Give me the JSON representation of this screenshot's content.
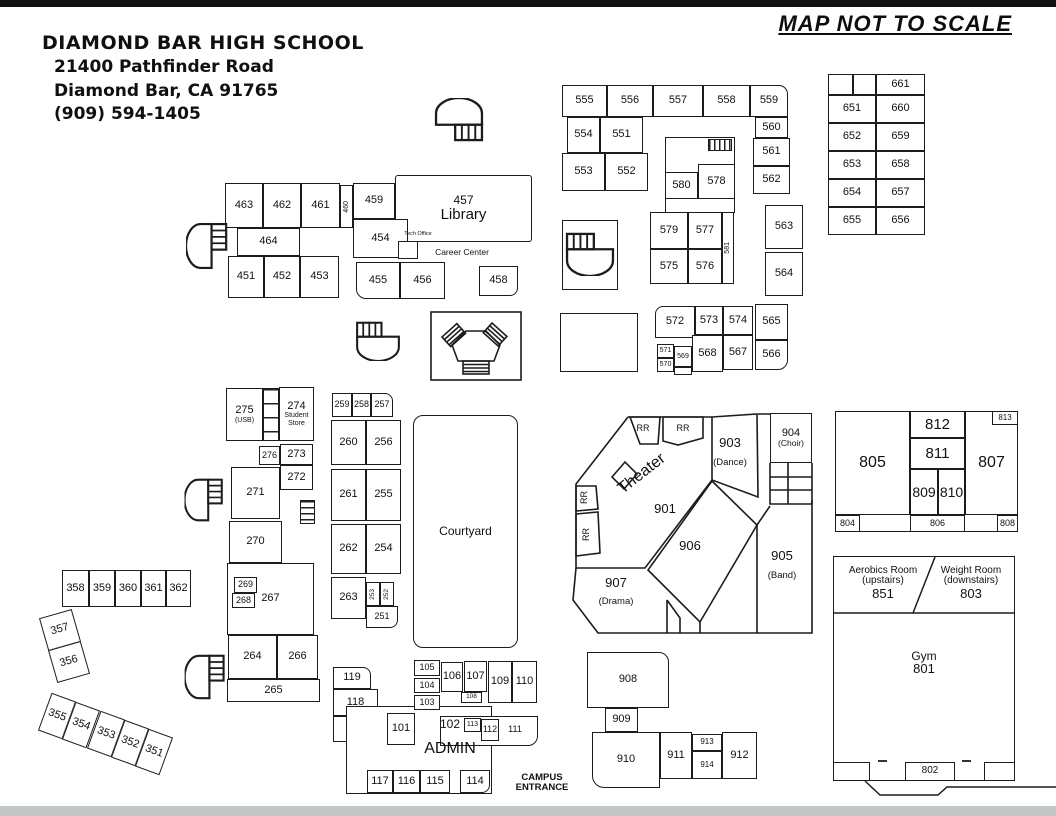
{
  "header": {
    "school": "DIAMOND BAR HIGH SCHOOL",
    "address1": "21400 Pathfinder Road",
    "address2": "Diamond Bar, CA 91765",
    "phone": "(909) 594-1405"
  },
  "map_note": "MAP NOT TO SCALE",
  "colors": {
    "line": "#1c1c1c",
    "top_bar": "#111111",
    "bottom_bar": "#c3c7c3",
    "paper": "#ffffff"
  },
  "rooms": [
    {
      "id": "cell-blank-1",
      "n": "",
      "x": 828,
      "y": 74,
      "w": 25,
      "h": 21
    },
    {
      "id": "cell-blank-2",
      "n": "",
      "x": 853,
      "y": 74,
      "w": 23,
      "h": 21
    },
    {
      "n": "661",
      "x": 876,
      "y": 74,
      "w": 49,
      "h": 21
    },
    {
      "n": "651",
      "x": 828,
      "y": 95,
      "w": 48,
      "h": 28
    },
    {
      "n": "660",
      "x": 876,
      "y": 95,
      "w": 49,
      "h": 28
    },
    {
      "n": "652",
      "x": 828,
      "y": 123,
      "w": 48,
      "h": 28
    },
    {
      "n": "659",
      "x": 876,
      "y": 123,
      "w": 49,
      "h": 28
    },
    {
      "n": "653",
      "x": 828,
      "y": 151,
      "w": 48,
      "h": 28
    },
    {
      "n": "658",
      "x": 876,
      "y": 151,
      "w": 49,
      "h": 28
    },
    {
      "n": "654",
      "x": 828,
      "y": 179,
      "w": 48,
      "h": 28
    },
    {
      "n": "657",
      "x": 876,
      "y": 179,
      "w": 49,
      "h": 28
    },
    {
      "n": "655",
      "x": 828,
      "y": 207,
      "w": 48,
      "h": 28
    },
    {
      "n": "656",
      "x": 876,
      "y": 207,
      "w": 49,
      "h": 28
    },
    {
      "n": "555",
      "x": 562,
      "y": 85,
      "w": 45,
      "h": 32
    },
    {
      "n": "556",
      "x": 607,
      "y": 85,
      "w": 46,
      "h": 32
    },
    {
      "n": "557",
      "x": 653,
      "y": 85,
      "w": 50,
      "h": 32
    },
    {
      "n": "558",
      "x": 703,
      "y": 85,
      "w": 47,
      "h": 32
    },
    {
      "n": "559",
      "x": 750,
      "y": 85,
      "w": 38,
      "h": 32,
      "br": "0 9px 0 0"
    },
    {
      "n": "554",
      "x": 567,
      "y": 117,
      "w": 33,
      "h": 36
    },
    {
      "n": "551",
      "x": 600,
      "y": 117,
      "w": 43,
      "h": 36
    },
    {
      "n": "553",
      "x": 562,
      "y": 153,
      "w": 43,
      "h": 38
    },
    {
      "n": "552",
      "x": 605,
      "y": 153,
      "w": 43,
      "h": 38
    },
    {
      "n": "560",
      "x": 755,
      "y": 117,
      "w": 33,
      "h": 21
    },
    {
      "n": "561",
      "x": 753,
      "y": 138,
      "w": 37,
      "h": 28
    },
    {
      "n": "562",
      "x": 753,
      "y": 166,
      "w": 37,
      "h": 28
    },
    {
      "n": "563",
      "x": 765,
      "y": 205,
      "w": 38,
      "h": 44
    },
    {
      "n": "564",
      "x": 765,
      "y": 252,
      "w": 38,
      "h": 44
    },
    {
      "id": "block-578-outline",
      "n": "",
      "x": 665,
      "y": 137,
      "w": 70,
      "h": 76
    },
    {
      "n": "580",
      "x": 665,
      "y": 172,
      "w": 33,
      "h": 27
    },
    {
      "n": "578",
      "x": 698,
      "y": 164,
      "w": 37,
      "h": 35
    },
    {
      "n": "579",
      "x": 650,
      "y": 212,
      "w": 38,
      "h": 37
    },
    {
      "n": "577",
      "x": 688,
      "y": 212,
      "w": 34,
      "h": 37
    },
    {
      "n": "575",
      "x": 650,
      "y": 249,
      "w": 38,
      "h": 35
    },
    {
      "n": "576",
      "x": 688,
      "y": 249,
      "w": 34,
      "h": 35
    },
    {
      "n": "581",
      "x": 722,
      "y": 212,
      "w": 12,
      "h": 72,
      "v": true,
      "fs": 7
    },
    {
      "id": "stair-box-550",
      "n": "",
      "x": 562,
      "y": 220,
      "w": 56,
      "h": 70
    },
    {
      "id": "blank-box",
      "n": "",
      "x": 560,
      "y": 313,
      "w": 78,
      "h": 59
    },
    {
      "n": "572",
      "x": 655,
      "y": 306,
      "w": 40,
      "h": 32,
      "br": "8px 0 0 0"
    },
    {
      "n": "573",
      "x": 695,
      "y": 306,
      "w": 28,
      "h": 29
    },
    {
      "n": "574",
      "x": 723,
      "y": 306,
      "w": 30,
      "h": 29
    },
    {
      "n": "565",
      "x": 755,
      "y": 304,
      "w": 33,
      "h": 36
    },
    {
      "n": "571",
      "x": 657,
      "y": 344,
      "w": 17,
      "h": 14,
      "fs": 7
    },
    {
      "n": "570",
      "x": 657,
      "y": 358,
      "w": 17,
      "h": 14,
      "fs": 7
    },
    {
      "n": "569",
      "x": 674,
      "y": 346,
      "w": 18,
      "h": 21,
      "fs": 7
    },
    {
      "id": "connector-569",
      "n": "",
      "x": 674,
      "y": 367,
      "w": 18,
      "h": 8
    },
    {
      "n": "568",
      "x": 692,
      "y": 335,
      "w": 31,
      "h": 37
    },
    {
      "n": "567",
      "x": 723,
      "y": 335,
      "w": 30,
      "h": 35
    },
    {
      "n": "566",
      "x": 755,
      "y": 340,
      "w": 33,
      "h": 30,
      "br": "0 0 10px 0"
    },
    {
      "n": "463",
      "x": 225,
      "y": 183,
      "w": 38,
      "h": 45
    },
    {
      "n": "462",
      "x": 263,
      "y": 183,
      "w": 38,
      "h": 45
    },
    {
      "n": "461",
      "x": 301,
      "y": 183,
      "w": 39,
      "h": 45
    },
    {
      "n": "460",
      "x": 340,
      "y": 185,
      "w": 13,
      "h": 43,
      "v": true,
      "fs": 7
    },
    {
      "n": "459",
      "x": 353,
      "y": 183,
      "w": 42,
      "h": 36
    },
    {
      "n": "457",
      "sub": "Library",
      "x": 395,
      "y": 175,
      "w": 137,
      "h": 67,
      "fs": 12,
      "subfs": 15,
      "br": "3px"
    },
    {
      "n": "464",
      "x": 237,
      "y": 228,
      "w": 63,
      "h": 28
    },
    {
      "n": "454",
      "x": 353,
      "y": 219,
      "w": 55,
      "h": 39
    },
    {
      "n": "451",
      "x": 228,
      "y": 256,
      "w": 36,
      "h": 42
    },
    {
      "n": "452",
      "x": 264,
      "y": 256,
      "w": 36,
      "h": 42
    },
    {
      "n": "453",
      "x": 300,
      "y": 256,
      "w": 39,
      "h": 42
    },
    {
      "n": "455",
      "x": 356,
      "y": 262,
      "w": 44,
      "h": 37,
      "br": "0 0 0 10px"
    },
    {
      "n": "456",
      "x": 400,
      "y": 262,
      "w": 45,
      "h": 37
    },
    {
      "n": "458",
      "x": 479,
      "y": 266,
      "w": 39,
      "h": 30,
      "br": "0 0 8px 0"
    },
    {
      "id": "tech-office-box",
      "n": "",
      "x": 398,
      "y": 241,
      "w": 20,
      "h": 18
    },
    {
      "id": "tech-office-label",
      "n": "Tech Office",
      "x": 396,
      "y": 230,
      "w": 44,
      "h": 9,
      "fs": 5.5,
      "plain": true
    },
    {
      "id": "career-center-label",
      "n": "Career Center",
      "x": 426,
      "y": 246,
      "w": 72,
      "h": 12,
      "fs": 8.5,
      "plain": true
    },
    {
      "n": "275",
      "sub": "(USB)",
      "x": 226,
      "y": 388,
      "w": 37,
      "h": 53,
      "subfs": 7
    },
    {
      "n": "274",
      "sub": "Student\nStore",
      "x": 279,
      "y": 387,
      "w": 35,
      "h": 54,
      "subfs": 7
    },
    {
      "n": "276",
      "x": 259,
      "y": 446,
      "w": 21,
      "h": 19,
      "fs": 9
    },
    {
      "n": "273",
      "x": 280,
      "y": 444,
      "w": 33,
      "h": 21
    },
    {
      "n": "272",
      "x": 280,
      "y": 465,
      "w": 33,
      "h": 25
    },
    {
      "n": "271",
      "x": 231,
      "y": 467,
      "w": 49,
      "h": 52
    },
    {
      "n": "270",
      "x": 229,
      "y": 521,
      "w": 53,
      "h": 42
    },
    {
      "n": "267",
      "x": 227,
      "y": 563,
      "w": 87,
      "h": 72
    },
    {
      "n": "269",
      "x": 234,
      "y": 577,
      "w": 23,
      "h": 16,
      "fs": 9
    },
    {
      "n": "268",
      "x": 232,
      "y": 593,
      "w": 23,
      "h": 15,
      "fs": 9
    },
    {
      "n": "264",
      "x": 228,
      "y": 635,
      "w": 49,
      "h": 44
    },
    {
      "n": "266",
      "x": 277,
      "y": 635,
      "w": 41,
      "h": 44
    },
    {
      "n": "265",
      "x": 227,
      "y": 679,
      "w": 93,
      "h": 23
    },
    {
      "n": "259",
      "x": 332,
      "y": 393,
      "w": 20,
      "h": 24,
      "fs": 9
    },
    {
      "n": "258",
      "x": 352,
      "y": 393,
      "w": 19,
      "h": 24,
      "fs": 9
    },
    {
      "n": "257",
      "x": 371,
      "y": 393,
      "w": 22,
      "h": 24,
      "fs": 9,
      "br": "0 8px 0 0"
    },
    {
      "n": "260",
      "x": 331,
      "y": 420,
      "w": 35,
      "h": 45
    },
    {
      "n": "256",
      "x": 366,
      "y": 420,
      "w": 35,
      "h": 45
    },
    {
      "n": "261",
      "x": 331,
      "y": 469,
      "w": 35,
      "h": 52
    },
    {
      "n": "255",
      "x": 366,
      "y": 469,
      "w": 35,
      "h": 52
    },
    {
      "n": "262",
      "x": 331,
      "y": 524,
      "w": 35,
      "h": 50
    },
    {
      "n": "254",
      "x": 366,
      "y": 524,
      "w": 35,
      "h": 50
    },
    {
      "n": "263",
      "x": 331,
      "y": 577,
      "w": 35,
      "h": 42
    },
    {
      "n": "253",
      "x": 366,
      "y": 582,
      "w": 14,
      "h": 24,
      "v": true,
      "fs": 6.5
    },
    {
      "n": "252",
      "x": 380,
      "y": 582,
      "w": 14,
      "h": 24,
      "v": true,
      "fs": 6.5
    },
    {
      "n": "251",
      "x": 366,
      "y": 606,
      "w": 32,
      "h": 22,
      "fs": 9,
      "br": "0 0 8px 0"
    },
    {
      "id": "courtyard",
      "n": "Courtyard",
      "x": 413,
      "y": 415,
      "w": 105,
      "h": 233,
      "fs": 12,
      "br": "10px"
    },
    {
      "n": "358",
      "x": 62,
      "y": 570,
      "w": 27,
      "h": 37
    },
    {
      "n": "359",
      "x": 89,
      "y": 570,
      "w": 26,
      "h": 37
    },
    {
      "n": "360",
      "x": 115,
      "y": 570,
      "w": 26,
      "h": 37
    },
    {
      "n": "361",
      "x": 141,
      "y": 570,
      "w": 25,
      "h": 37
    },
    {
      "n": "362",
      "x": 166,
      "y": 570,
      "w": 25,
      "h": 37
    },
    {
      "n": "357",
      "x": 43,
      "y": 613,
      "w": 34,
      "h": 34,
      "rot": -16
    },
    {
      "n": "356",
      "x": 52,
      "y": 645,
      "w": 34,
      "h": 34,
      "rot": -16
    },
    {
      "n": "355",
      "x": 44,
      "y": 696,
      "w": 26,
      "h": 40,
      "rot": 20
    },
    {
      "n": "354",
      "x": 68,
      "y": 705,
      "w": 26,
      "h": 40,
      "rot": 20
    },
    {
      "n": "353",
      "x": 93,
      "y": 714,
      "w": 26,
      "h": 40,
      "rot": 20
    },
    {
      "n": "352",
      "x": 117,
      "y": 723,
      "w": 26,
      "h": 40,
      "rot": 20
    },
    {
      "n": "351",
      "x": 141,
      "y": 732,
      "w": 26,
      "h": 40,
      "rot": 20
    },
    {
      "n": "119",
      "x": 333,
      "y": 667,
      "w": 38,
      "h": 22,
      "br": "0 8px 0 0"
    },
    {
      "n": "118",
      "x": 333,
      "y": 689,
      "w": 45,
      "h": 27
    },
    {
      "id": "bldg-118-tail",
      "n": "",
      "x": 333,
      "y": 716,
      "w": 22,
      "h": 26
    },
    {
      "id": "admin-shell",
      "n": "",
      "x": 346,
      "y": 706,
      "w": 146,
      "h": 88
    },
    {
      "id": "admin-wing",
      "n": "",
      "x": 440,
      "y": 716,
      "w": 98,
      "h": 30,
      "br": "0 0 10px 0"
    },
    {
      "n": "105",
      "x": 414,
      "y": 660,
      "w": 26,
      "h": 16,
      "fs": 9
    },
    {
      "n": "104",
      "x": 414,
      "y": 678,
      "w": 26,
      "h": 15,
      "fs": 9
    },
    {
      "n": "103",
      "x": 414,
      "y": 695,
      "w": 26,
      "h": 15,
      "fs": 9
    },
    {
      "n": "106",
      "x": 441,
      "y": 662,
      "w": 22,
      "h": 30
    },
    {
      "n": "107",
      "x": 464,
      "y": 661,
      "w": 23,
      "h": 31
    },
    {
      "n": "108",
      "x": 461,
      "y": 692,
      "w": 21,
      "h": 11,
      "fs": 6.5
    },
    {
      "n": "109",
      "x": 488,
      "y": 661,
      "w": 24,
      "h": 42
    },
    {
      "n": "110",
      "x": 512,
      "y": 661,
      "w": 25,
      "h": 42
    },
    {
      "n": "101",
      "x": 387,
      "y": 713,
      "w": 28,
      "h": 32
    },
    {
      "id": "label-102",
      "n": "102",
      "x": 436,
      "y": 715,
      "w": 28,
      "h": 18,
      "plain": true,
      "fs": 12
    },
    {
      "n": "113",
      "x": 464,
      "y": 718,
      "w": 17,
      "h": 14,
      "fs": 7
    },
    {
      "n": "112",
      "x": 481,
      "y": 719,
      "w": 18,
      "h": 22,
      "fs": 9
    },
    {
      "id": "label-111",
      "n": "111",
      "x": 504,
      "y": 719,
      "w": 22,
      "h": 22,
      "plain": true,
      "fs": 9
    },
    {
      "id": "label-admin",
      "n": "ADMIN",
      "x": 420,
      "y": 738,
      "w": 60,
      "h": 22,
      "plain": true,
      "fs": 16
    },
    {
      "n": "117",
      "x": 367,
      "y": 770,
      "w": 26,
      "h": 23
    },
    {
      "n": "116",
      "x": 393,
      "y": 770,
      "w": 27,
      "h": 23
    },
    {
      "n": "115",
      "x": 420,
      "y": 770,
      "w": 30,
      "h": 23
    },
    {
      "n": "114",
      "x": 460,
      "y": 770,
      "w": 30,
      "h": 23,
      "br": "0 0 8px 0"
    },
    {
      "id": "campus-entrance",
      "n": "CAMPUS\nENTRANCE",
      "x": 508,
      "y": 770,
      "w": 68,
      "h": 26,
      "plain": true,
      "fs": 9.5,
      "bold": true
    },
    {
      "id": "label-rr-1",
      "n": "RR",
      "x": 630,
      "y": 419,
      "w": 26,
      "h": 20,
      "plain": true,
      "fs": 9
    },
    {
      "id": "label-rr-2",
      "n": "RR",
      "x": 668,
      "y": 419,
      "w": 30,
      "h": 20,
      "plain": true,
      "fs": 9
    },
    {
      "id": "label-rr-3",
      "n": "RR",
      "x": 575,
      "y": 486,
      "w": 20,
      "h": 23,
      "plain": true,
      "fs": 9,
      "v": true
    },
    {
      "id": "label-rr-4",
      "n": "RR",
      "x": 577,
      "y": 517,
      "w": 20,
      "h": 34,
      "plain": true,
      "fs": 9,
      "v": true
    },
    {
      "id": "label-theater",
      "n": "Theater",
      "x": 597,
      "y": 452,
      "w": 90,
      "h": 44,
      "plain": true,
      "fs": 16,
      "rot": -38
    },
    {
      "id": "label-901",
      "n": "901",
      "x": 645,
      "y": 500,
      "w": 40,
      "h": 18,
      "plain": true,
      "fs": 13
    },
    {
      "id": "label-903",
      "n": "903",
      "x": 706,
      "y": 434,
      "w": 48,
      "h": 18,
      "plain": true,
      "fs": 13
    },
    {
      "id": "label-dance",
      "n": "(Dance)",
      "x": 702,
      "y": 456,
      "w": 56,
      "h": 14,
      "plain": true,
      "fs": 9.5
    },
    {
      "n": "904",
      "sub": "(Choir)",
      "x": 770,
      "y": 413,
      "w": 42,
      "h": 50,
      "subfs": 8.5
    },
    {
      "id": "label-906",
      "n": "906",
      "x": 670,
      "y": 537,
      "w": 40,
      "h": 18,
      "plain": true,
      "fs": 13
    },
    {
      "id": "label-907",
      "n": "907",
      "x": 594,
      "y": 574,
      "w": 44,
      "h": 18,
      "plain": true,
      "fs": 13
    },
    {
      "id": "label-drama",
      "n": "(Drama)",
      "x": 588,
      "y": 595,
      "w": 56,
      "h": 14,
      "plain": true,
      "fs": 9.5
    },
    {
      "id": "label-905",
      "n": "905",
      "x": 760,
      "y": 547,
      "w": 44,
      "h": 18,
      "plain": true,
      "fs": 13
    },
    {
      "id": "label-band",
      "n": "(Band)",
      "x": 758,
      "y": 569,
      "w": 48,
      "h": 14,
      "plain": true,
      "fs": 9.5
    },
    {
      "n": "908",
      "x": 587,
      "y": 652,
      "w": 82,
      "h": 56,
      "br": "0 10px 0 0"
    },
    {
      "n": "909",
      "x": 605,
      "y": 708,
      "w": 33,
      "h": 24
    },
    {
      "n": "910",
      "x": 592,
      "y": 732,
      "w": 68,
      "h": 56,
      "br": "0 0 0 12px"
    },
    {
      "n": "911",
      "x": 660,
      "y": 732,
      "w": 32,
      "h": 47
    },
    {
      "n": "913",
      "x": 692,
      "y": 734,
      "w": 30,
      "h": 17,
      "fs": 8
    },
    {
      "n": "914",
      "x": 692,
      "y": 751,
      "w": 30,
      "h": 28,
      "fs": 8
    },
    {
      "n": "912",
      "x": 722,
      "y": 732,
      "w": 35,
      "h": 47
    },
    {
      "id": "bldg-800-shell",
      "n": "",
      "x": 835,
      "y": 411,
      "w": 183,
      "h": 121
    },
    {
      "n": "805",
      "x": 835,
      "y": 411,
      "w": 75,
      "h": 104,
      "fs": 16
    },
    {
      "n": "804",
      "x": 835,
      "y": 515,
      "w": 25,
      "h": 17,
      "fs": 9
    },
    {
      "n": "812",
      "x": 910,
      "y": 411,
      "w": 55,
      "h": 27,
      "fs": 15
    },
    {
      "n": "811",
      "x": 910,
      "y": 438,
      "w": 55,
      "h": 31,
      "fs": 15
    },
    {
      "n": "809",
      "x": 910,
      "y": 469,
      "w": 28,
      "h": 46,
      "fs": 14
    },
    {
      "n": "810",
      "x": 938,
      "y": 469,
      "w": 27,
      "h": 46,
      "fs": 14
    },
    {
      "n": "806",
      "x": 910,
      "y": 515,
      "w": 55,
      "h": 17,
      "fs": 9
    },
    {
      "n": "807",
      "x": 965,
      "y": 411,
      "w": 53,
      "h": 104,
      "fs": 16
    },
    {
      "n": "813",
      "x": 992,
      "y": 411,
      "w": 26,
      "h": 14,
      "fs": 8
    },
    {
      "n": "808",
      "x": 997,
      "y": 515,
      "w": 21,
      "h": 17,
      "fs": 9
    },
    {
      "id": "gym-shell",
      "n": "",
      "x": 833,
      "y": 556,
      "w": 182,
      "h": 225
    },
    {
      "id": "room-851",
      "n": "Aerobics Room\n(upstairs)",
      "sub": "851",
      "x": 836,
      "y": 560,
      "w": 94,
      "h": 46,
      "fs": 10,
      "subfs": 13,
      "plain": true
    },
    {
      "id": "room-803",
      "n": "Weight Room\n(downstairs)",
      "sub": "803",
      "x": 928,
      "y": 560,
      "w": 86,
      "h": 46,
      "fs": 10,
      "subfs": 13,
      "plain": true
    },
    {
      "id": "room-801",
      "n": "Gym",
      "sub": "801",
      "x": 898,
      "y": 645,
      "w": 52,
      "h": 36,
      "fs": 12,
      "subfs": 13,
      "plain": true
    },
    {
      "id": "gym-door-left",
      "n": "",
      "x": 833,
      "y": 762,
      "w": 37,
      "h": 19
    },
    {
      "n": "802",
      "x": 905,
      "y": 762,
      "w": 50,
      "h": 19,
      "fs": 10
    },
    {
      "id": "gym-door-right",
      "n": "",
      "x": 984,
      "y": 762,
      "w": 31,
      "h": 19
    }
  ]
}
